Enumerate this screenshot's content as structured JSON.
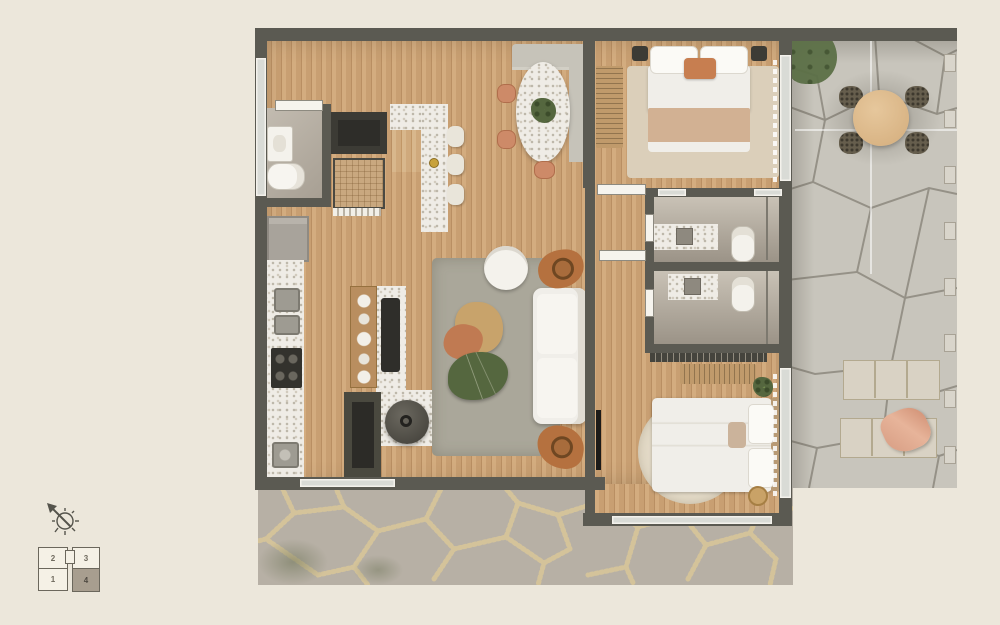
{
  "palette": {
    "background": "#ece7db",
    "wall": "#5b5a52",
    "wood-a": "#d3ac7f",
    "wood-b": "#c89f72",
    "wood-line": "#b98f63",
    "stone": "#c8c5bc",
    "stone-joint": "#8d897e",
    "terrace": "#b7b0a5",
    "pebble": "#d6c59a",
    "terrazzo": "#efece6",
    "speckle": "#b9b3a6",
    "white-soft": "#f0eee9",
    "gray-bench": "#c6c3b9",
    "rug-gray": "#aaa79a",
    "rug-beige": "#dbcfba",
    "rug-round": "#e3dac7",
    "blanket": "#d2b193",
    "terracotta": "#cd8a68",
    "green": "#55673f",
    "wood-furn": "#c09a6b",
    "dark-furn": "#3c3b35",
    "glass": "#d9dbd6",
    "keyplan-fill": "#f5f1e6",
    "keyplan-active": "#a89e8f",
    "keyplan-line": "#6b675c"
  },
  "compass": {
    "direction": "northwest"
  },
  "keyplan": {
    "units": [
      {
        "label": "2",
        "highlighted": false
      },
      {
        "label": "3",
        "highlighted": false
      },
      {
        "label": "1",
        "highlighted": false
      },
      {
        "label": "4",
        "highlighted": true
      }
    ]
  }
}
